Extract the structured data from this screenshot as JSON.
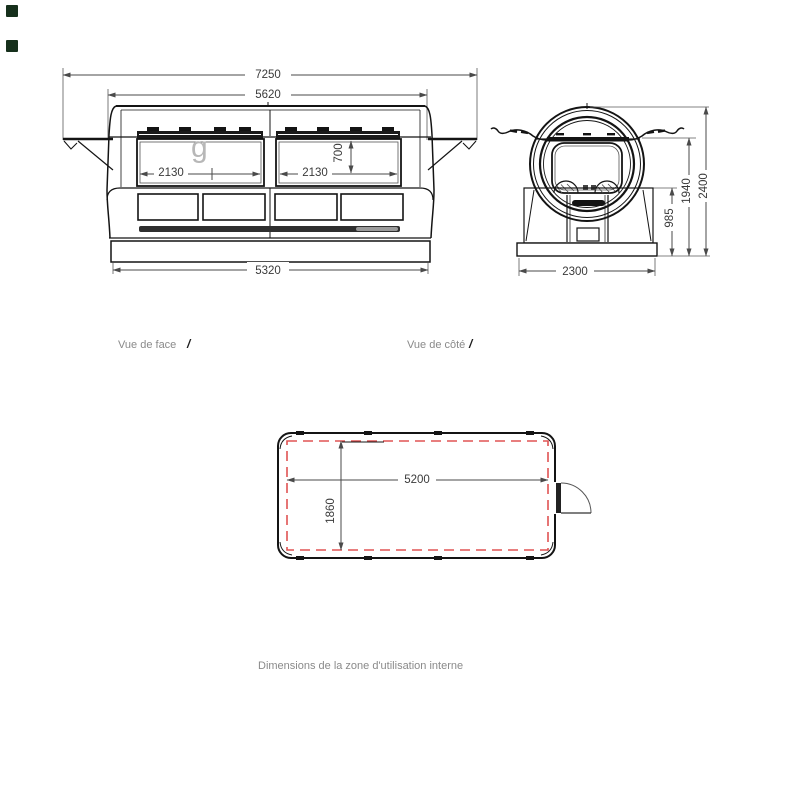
{
  "window": {
    "background": "#ffffff"
  },
  "decorations": {
    "top_left_markers": {
      "count": 2,
      "color": "#16301c"
    }
  },
  "front_view": {
    "label": "Vue de face",
    "label_mark": "/",
    "watermark": "g",
    "dim_overall_width": "7250",
    "dim_upper_width": "5620",
    "dim_left_hatch_width": "2130",
    "dim_right_hatch_width": "2130",
    "dim_hatch_height": "700",
    "dim_base_width": "5320"
  },
  "side_view": {
    "label": "Vue de côté",
    "label_mark": "/",
    "dim_base_width": "2300",
    "dim_base_height": "985",
    "dim_mid_height": "1940",
    "dim_overall_height": "2400"
  },
  "plan_view": {
    "caption": "Dimensions de la zone d'utilisation interne",
    "dim_internal_length": "5200",
    "dim_internal_width": "1860"
  },
  "colors": {
    "drawing_line": "#141414",
    "dimension_line": "#4a4a4a",
    "dimension_text": "#3a3a3a",
    "label_text": "#8a8a8a",
    "internal_zone_dashed": "#e05353",
    "watermark": "#b7b7b7",
    "marker_green": "#16301c"
  }
}
